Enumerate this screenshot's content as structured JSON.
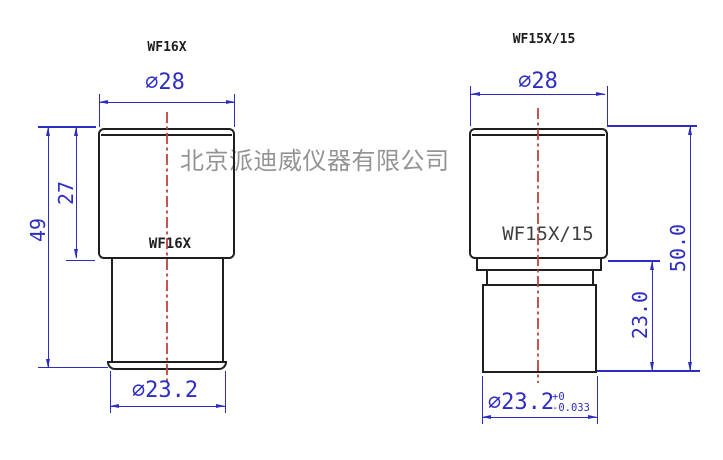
{
  "document": {
    "kind": "technical-drawing",
    "background": "#ffffff"
  },
  "colors": {
    "dimension_blue": "#2d2dc3",
    "outline_black": "#1f1f1f",
    "centerline_red": "#c24040",
    "watermark_gray": "#8f8f8f"
  },
  "watermark": {
    "text": "北京派迪威仪器有限公司"
  },
  "views": {
    "left": {
      "title": "WF16X",
      "body_label": "WF16X",
      "dims": {
        "top_diameter": "∅28",
        "cap_height": "27",
        "total_height": "49",
        "barrel_diameter": "∅23.2"
      }
    },
    "right": {
      "title": "WF15X/15",
      "body_label": "WF15X/15",
      "dims": {
        "top_diameter": "∅28",
        "barrel_height": "23.0",
        "total_height": "50.0",
        "barrel_diameter": "∅23.2",
        "barrel_diameter_tol_upper": "+0",
        "barrel_diameter_tol_lower": "-0.033"
      }
    }
  }
}
